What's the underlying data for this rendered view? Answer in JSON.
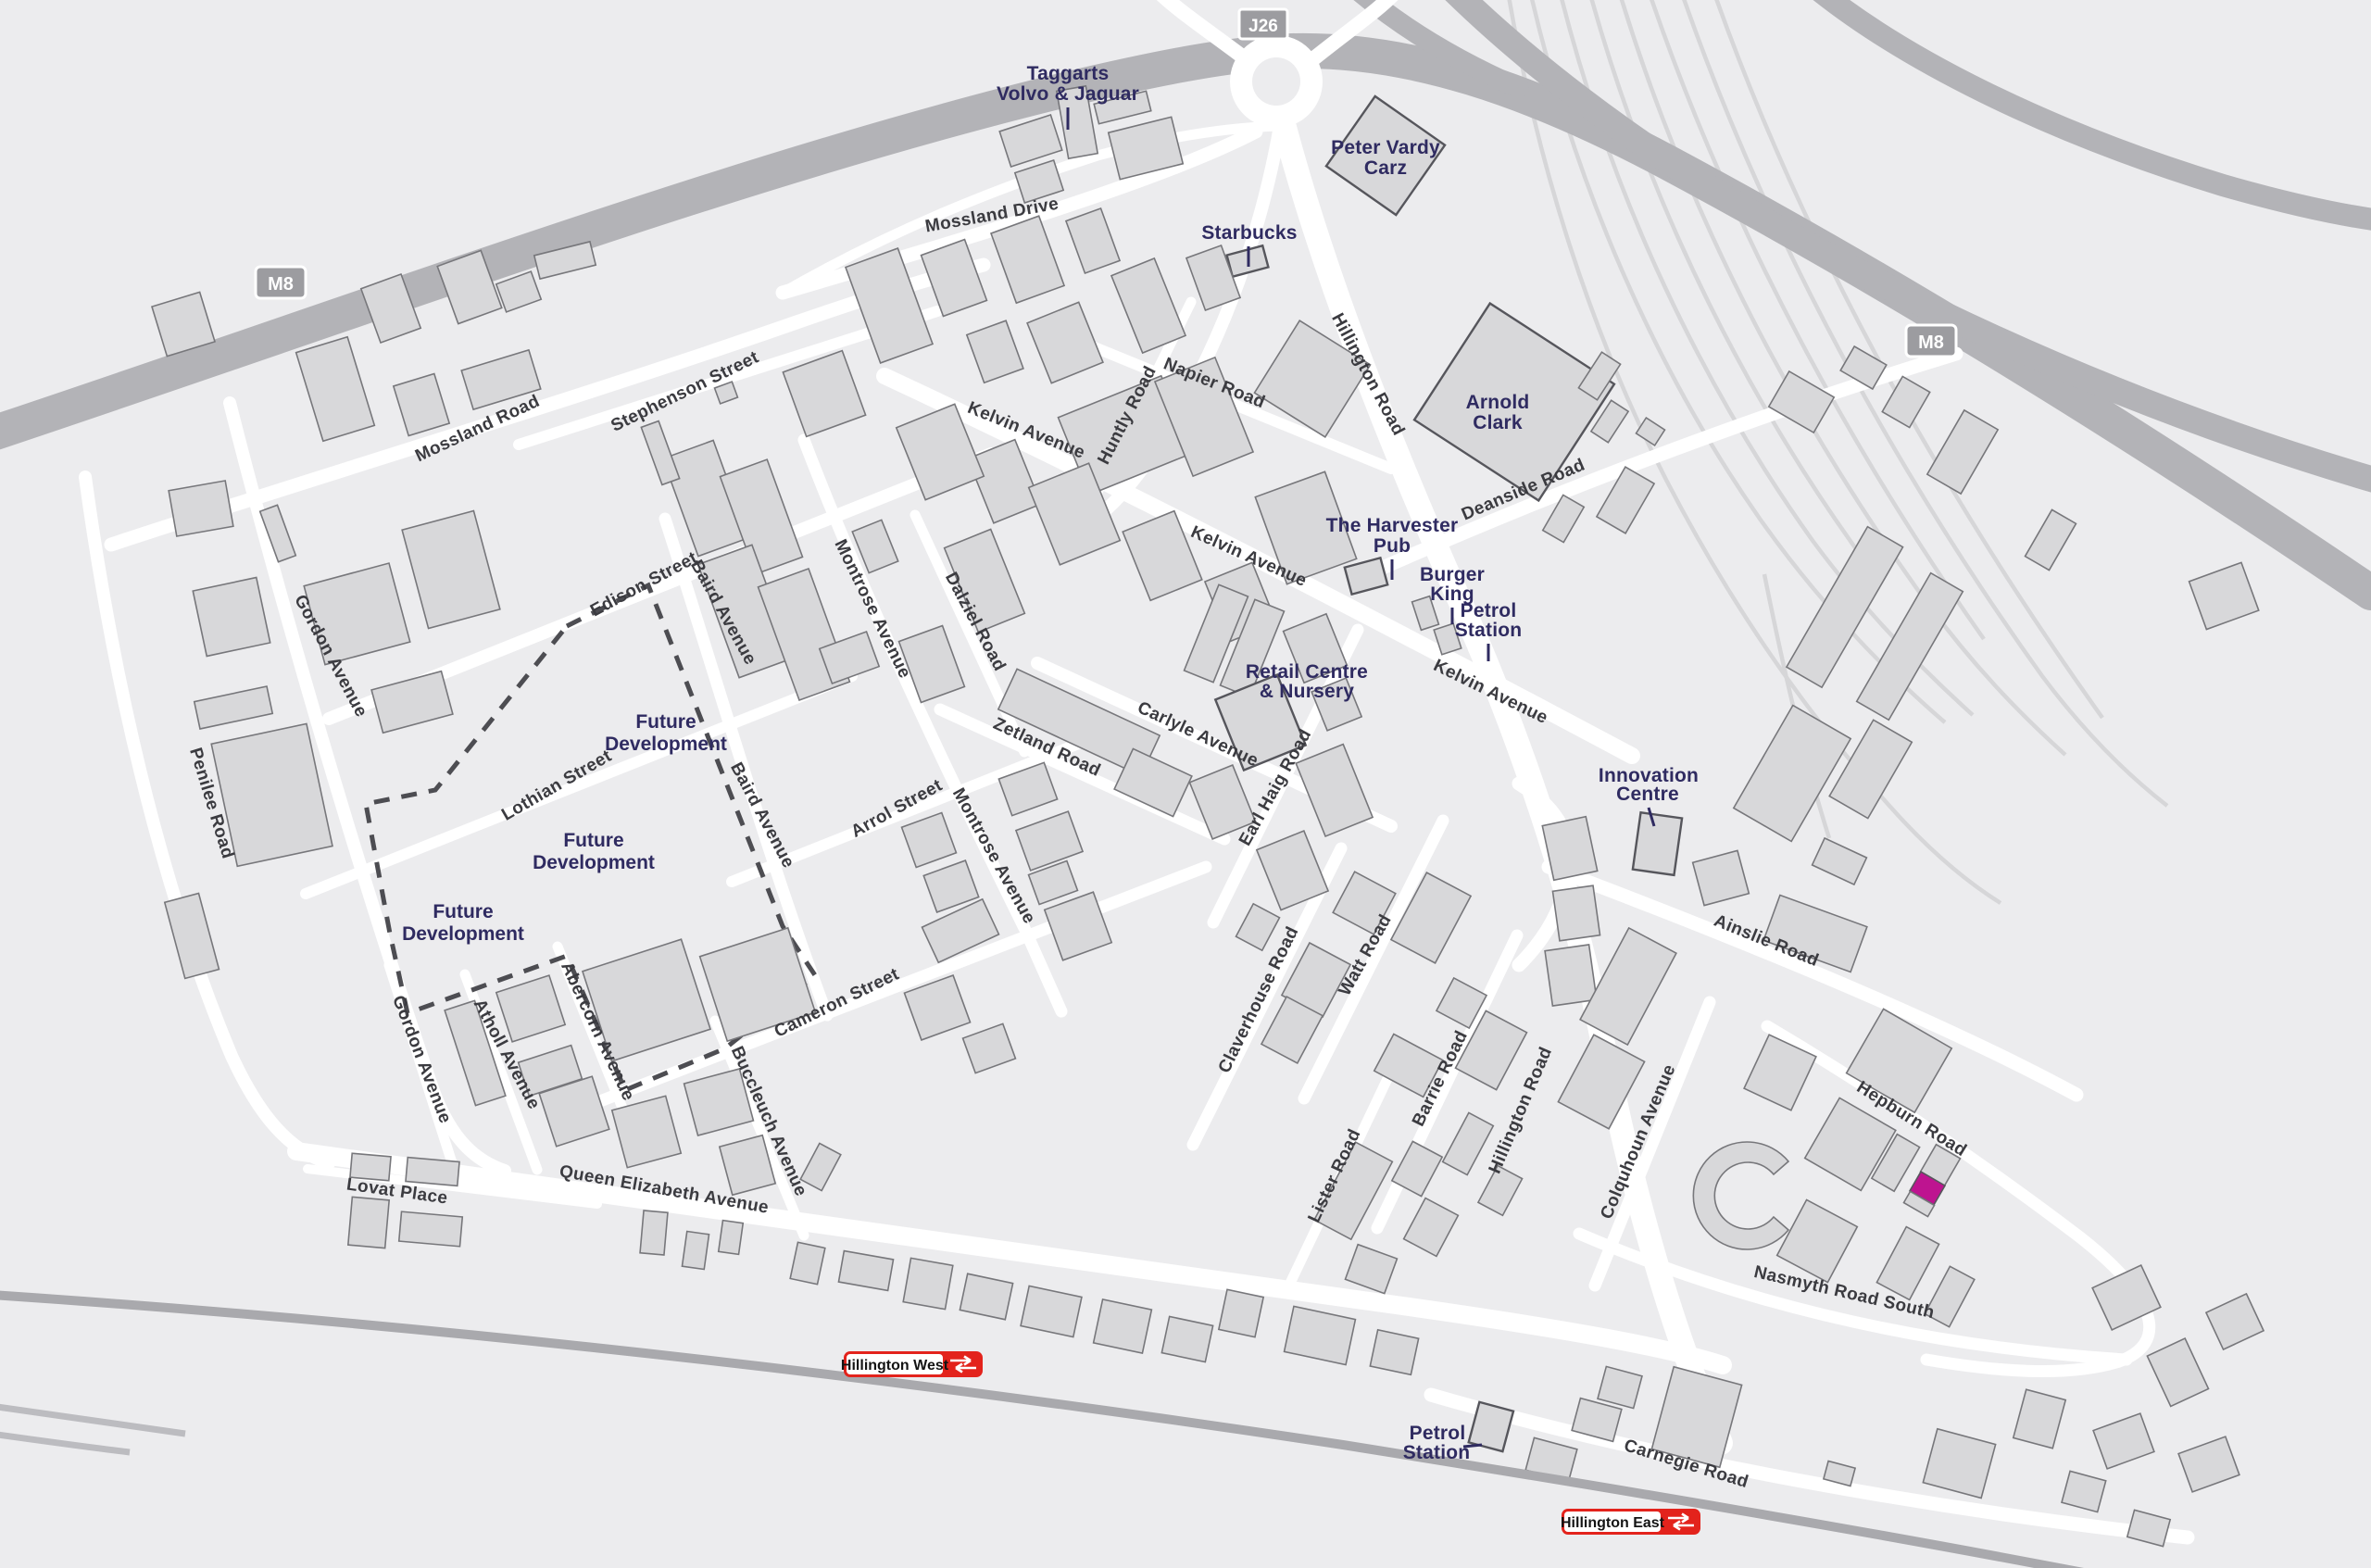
{
  "badges": {
    "motorway_left": "M8",
    "motorway_right": "M8",
    "junction": "J26"
  },
  "stations": [
    {
      "name": "Hillington West"
    },
    {
      "name": "Hillington East"
    }
  ],
  "landmarks": [
    {
      "id": "taggarts",
      "line1": "Taggarts",
      "line2": "Volvo & Jaguar"
    },
    {
      "id": "peter-vardy",
      "line1": "Peter Vardy",
      "line2": "Carz"
    },
    {
      "id": "starbucks",
      "line1": "Starbucks"
    },
    {
      "id": "arnold-clark",
      "line1": "Arnold",
      "line2": "Clark"
    },
    {
      "id": "harvester-pub",
      "line1": "The Harvester",
      "line2": "Pub"
    },
    {
      "id": "burger-king",
      "line1": "Burger",
      "line2": "King"
    },
    {
      "id": "petrol-station-north",
      "line1": "Petrol",
      "line2": "Station"
    },
    {
      "id": "retail-centre",
      "line1": "Retail Centre",
      "line2": "& Nursery"
    },
    {
      "id": "innovation-centre",
      "line1": "Innovation",
      "line2": "Centre"
    },
    {
      "id": "petrol-station-south",
      "line1": "Petrol",
      "line2": "Station"
    }
  ],
  "areas": [
    {
      "line1": "Future",
      "line2": "Development"
    },
    {
      "line1": "Future",
      "line2": "Development"
    },
    {
      "line1": "Future",
      "line2": "Development"
    }
  ],
  "roads": [
    {
      "name": "Mossland Drive"
    },
    {
      "name": "Mossland Road"
    },
    {
      "name": "Stephenson Street"
    },
    {
      "name": "Edison Street"
    },
    {
      "name": "Baird Avenue"
    },
    {
      "name": "Baird Avenue"
    },
    {
      "name": "Montrose Avenue"
    },
    {
      "name": "Montrose Avenue"
    },
    {
      "name": "Lothian Street"
    },
    {
      "name": "Arrol Street"
    },
    {
      "name": "Gordon Avenue"
    },
    {
      "name": "Gordon Avenue"
    },
    {
      "name": "Penilee Road"
    },
    {
      "name": "Atholl Avenue"
    },
    {
      "name": "Abercorn Avenue"
    },
    {
      "name": "Cameron Street"
    },
    {
      "name": "Buccleuch Avenue"
    },
    {
      "name": "Queen Elizabeth Avenue"
    },
    {
      "name": "Lovat Place"
    },
    {
      "name": "Dalziel Road"
    },
    {
      "name": "Zetland Road"
    },
    {
      "name": "Carlyle Avenue"
    },
    {
      "name": "Kelvin Avenue"
    },
    {
      "name": "Kelvin Avenue"
    },
    {
      "name": "Kelvin Avenue"
    },
    {
      "name": "Napier Road"
    },
    {
      "name": "Huntly Road"
    },
    {
      "name": "Hillington Road"
    },
    {
      "name": "Hillington Road"
    },
    {
      "name": "Deanside Road"
    },
    {
      "name": "Earl Haig Road"
    },
    {
      "name": "Claverhouse Road"
    },
    {
      "name": "Watt Road"
    },
    {
      "name": "Barrie Road"
    },
    {
      "name": "Lister Road"
    },
    {
      "name": "Colquhoun Avenue"
    },
    {
      "name": "Ainslie Road"
    },
    {
      "name": "Hepburn Road"
    },
    {
      "name": "Nasmyth Road South"
    },
    {
      "name": "Carnegie Road"
    }
  ],
  "colors": {
    "background": "#ececee",
    "road": "#ffffff",
    "motorway": "#b3b3b7",
    "building": "#d8d8da",
    "building_outline": "#6e6e72",
    "railway": "#a9a9ad",
    "label_navy": "#2f2b61",
    "label_road": "#3b3b40",
    "station_red": "#e3231c",
    "badge_grey": "#9c9ca0",
    "highlight_magenta": "#be1490"
  }
}
